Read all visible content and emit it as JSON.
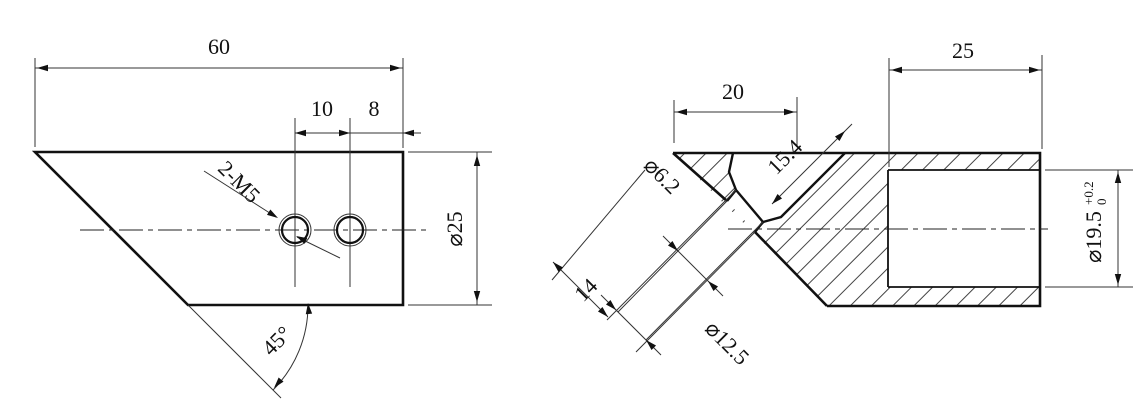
{
  "drawing": {
    "title": "two-view section drawing of angled cylindrical part",
    "colors": {
      "line": "#111111",
      "thin": "#333333",
      "background": "#ffffff"
    },
    "left_view": {
      "dim_60": "60",
      "dim_10": "10",
      "dim_8": "8",
      "dim_dia25": "⌀25",
      "dim_angle": "45°",
      "thread_label": "2-M5"
    },
    "right_view": {
      "dim_20": "20",
      "dim_25": "25",
      "dim_dia19_5": "⌀19.5",
      "tol_upper": "+0.2",
      "tol_lower": "0",
      "dim_dia6_2": "⌀6.2",
      "dim_14": "14",
      "dim_dia12_5": "⌀12.5",
      "dim_15_4": "15.4"
    }
  }
}
